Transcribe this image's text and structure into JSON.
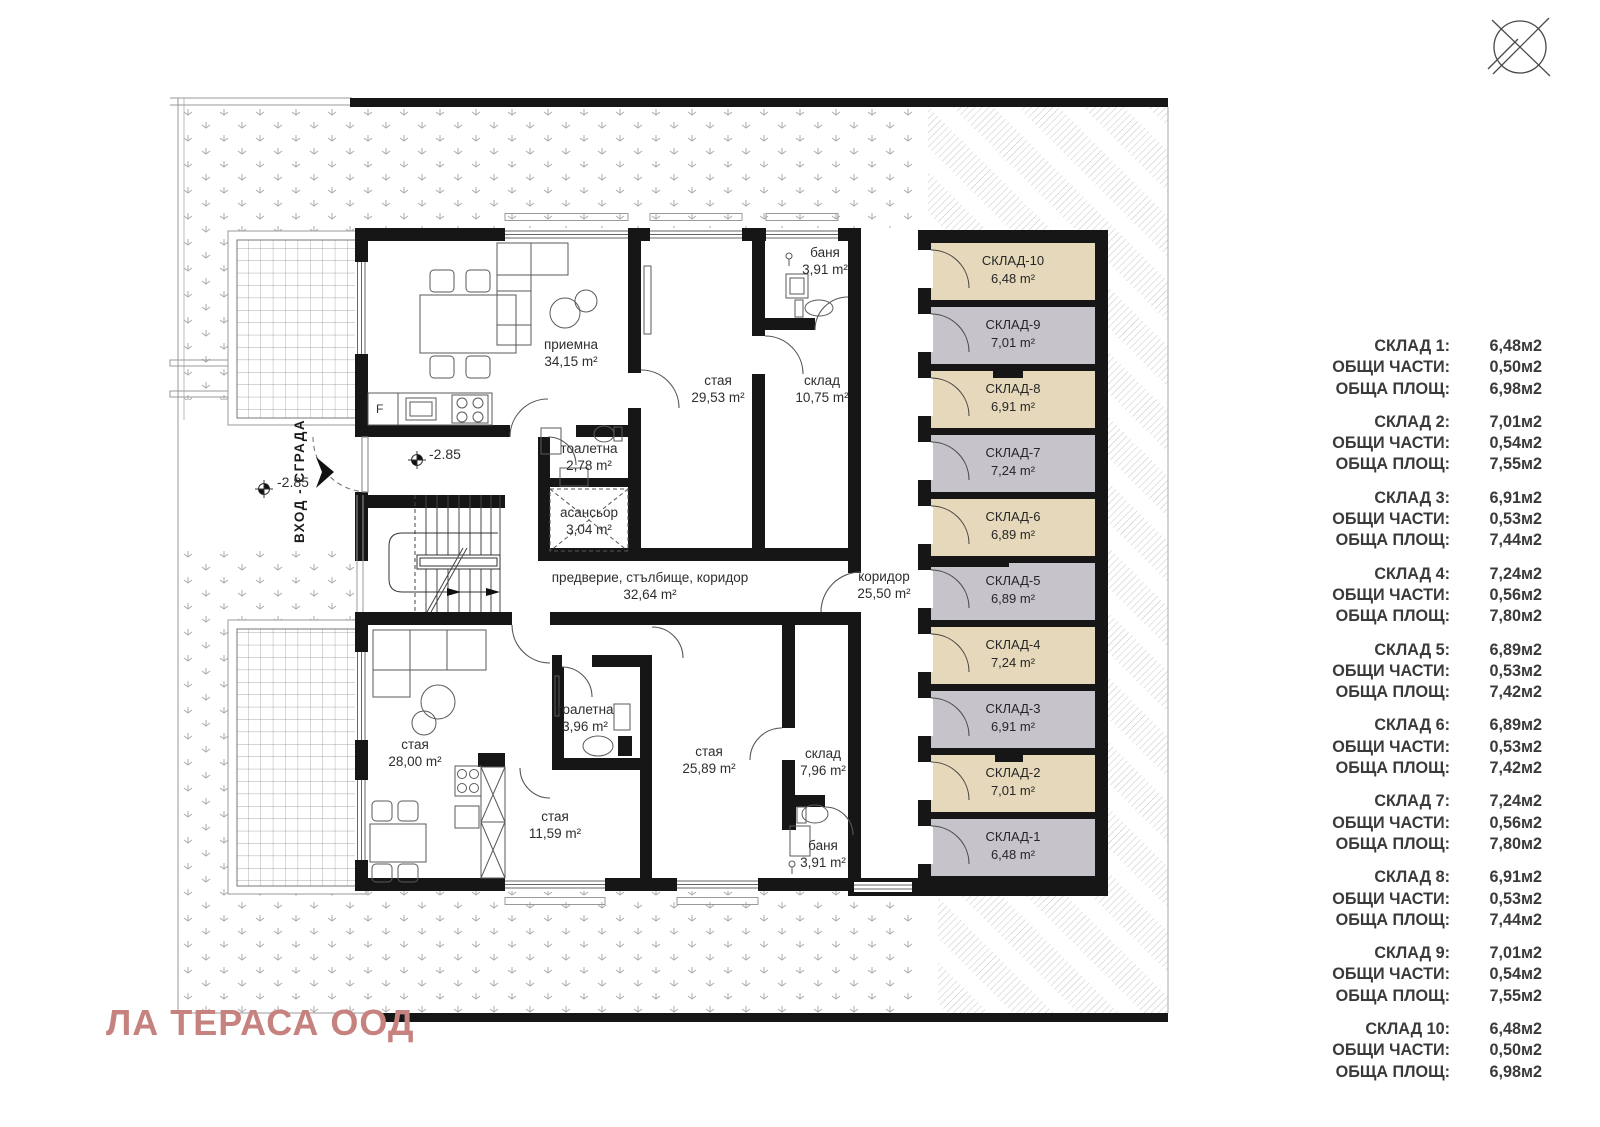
{
  "plan": {
    "rooms": [
      {
        "id": "priemna",
        "name": "приемна",
        "area": "34,15 m²"
      },
      {
        "id": "staya-upper",
        "name": "стая",
        "area": "29,53 m²"
      },
      {
        "id": "sklad-upper",
        "name": "склад",
        "area": "10,75 m²"
      },
      {
        "id": "banya-upper",
        "name": "баня",
        "area": "3,91 m²"
      },
      {
        "id": "toaletna-upper",
        "name": "тоалетна",
        "area": "2,78 m²"
      },
      {
        "id": "asansior",
        "name": "асансьор",
        "area": "3,04 m²"
      },
      {
        "id": "foyer",
        "name": "предверие, стълбище, коридор",
        "area": "32,64 m²"
      },
      {
        "id": "koridor",
        "name": "коридор",
        "area": "25,50 m²"
      },
      {
        "id": "staya-lower-left",
        "name": "стая",
        "area": "28,00 m²"
      },
      {
        "id": "toaletna-lower",
        "name": "тоалетна",
        "area": "3,96 m²"
      },
      {
        "id": "staya-lower-mid",
        "name": "стая",
        "area": "11,59 m²"
      },
      {
        "id": "staya-lower-right",
        "name": "стая",
        "area": "25,89 m²"
      },
      {
        "id": "sklad-lower",
        "name": "склад",
        "area": "7,96 m²"
      },
      {
        "id": "banya-lower",
        "name": "баня",
        "area": "3,91 m²"
      }
    ],
    "storage_units": [
      {
        "label": "СКЛАД-10",
        "area": "6,48 m²",
        "color_hex": "#e6d8bb"
      },
      {
        "label": "СКЛАД-9",
        "area": "7,01 m²",
        "color_hex": "#c6c3ca"
      },
      {
        "label": "СКЛАД-8",
        "area": "6,91 m²",
        "color_hex": "#e6d8bb"
      },
      {
        "label": "СКЛАД-7",
        "area": "7,24 m²",
        "color_hex": "#c6c3ca"
      },
      {
        "label": "СКЛАД-6",
        "area": "6,89 m²",
        "color_hex": "#e6d8bb"
      },
      {
        "label": "СКЛАД-5",
        "area": "6,89 m²",
        "color_hex": "#c6c3ca"
      },
      {
        "label": "СКЛАД-4",
        "area": "7,24 m²",
        "color_hex": "#e6d8bb"
      },
      {
        "label": "СКЛАД-3",
        "area": "6,91 m²",
        "color_hex": "#c6c3ca"
      },
      {
        "label": "СКЛАД-2",
        "area": "7,01 m²",
        "color_hex": "#e6d8bb"
      },
      {
        "label": "СКЛАД-1",
        "area": "6,48 m²",
        "color_hex": "#c6c3ca"
      }
    ],
    "annotations": {
      "entrance_label": "ВХОД - СГРАДА",
      "level_marks": [
        "-2.85",
        "-2.85"
      ],
      "fridge_label": "F"
    }
  },
  "legend": {
    "common_label": "ОБЩИ ЧАСТИ:",
    "total_label": "ОБЩА ПЛОЩ:",
    "entries": [
      {
        "name": "СКЛАД 1:",
        "area": "6,48м2",
        "common": "0,50м2",
        "total": "6,98м2"
      },
      {
        "name": "СКЛАД 2:",
        "area": "7,01м2",
        "common": "0,54м2",
        "total": "7,55м2"
      },
      {
        "name": "СКЛАД 3:",
        "area": "6,91м2",
        "common": "0,53м2",
        "total": "7,44м2"
      },
      {
        "name": "СКЛАД 4:",
        "area": "7,24м2",
        "common": "0,56м2",
        "total": "7,80м2"
      },
      {
        "name": "СКЛАД 5:",
        "area": "6,89м2",
        "common": "0,53м2",
        "total": "7,42м2"
      },
      {
        "name": "СКЛАД 6:",
        "area": "6,89м2",
        "common": "0,53м2",
        "total": "7,42м2"
      },
      {
        "name": "СКЛАД 7:",
        "area": "7,24м2",
        "common": "0,56м2",
        "total": "7,80м2"
      },
      {
        "name": "СКЛАД 8:",
        "area": "6,91м2",
        "common": "0,53м2",
        "total": "7,44м2"
      },
      {
        "name": "СКЛАД 9:",
        "area": "7,01м2",
        "common": "0,54м2",
        "total": "7,55м2"
      },
      {
        "name": "СКЛАД 10:",
        "area": "6,48м2",
        "common": "0,50м2",
        "total": "6,98м2"
      }
    ]
  },
  "watermark": "ЛА ТЕРАСА ООД"
}
